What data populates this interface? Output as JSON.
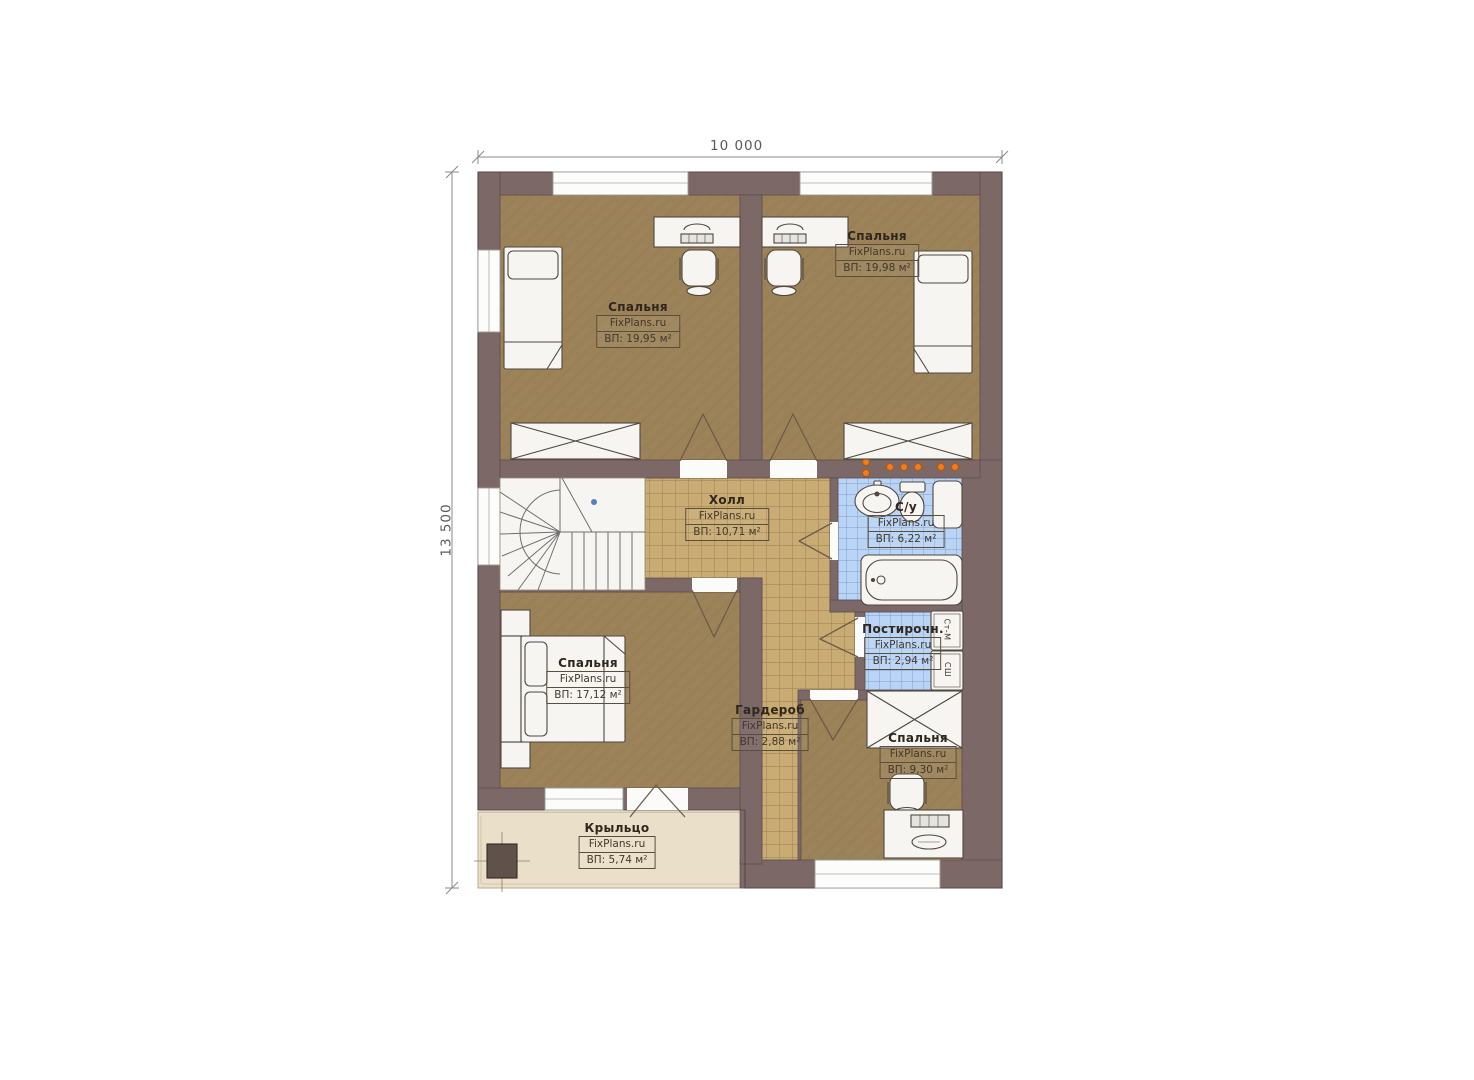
{
  "plan": {
    "type": "floor-plan",
    "watermark": "FixPlans.ru",
    "dimensions": {
      "width": "10 000",
      "height": "13 500"
    },
    "rooms": [
      {
        "id": "bedroom-top-left",
        "name": "Спальня",
        "watermark": "FixPlans.ru",
        "area": "ВП: 19,95 м²"
      },
      {
        "id": "bedroom-top-right",
        "name": "Спальня",
        "watermark": "FixPlans.ru",
        "area": "ВП: 19,98 м²"
      },
      {
        "id": "hall",
        "name": "Холл",
        "watermark": "FixPlans.ru",
        "area": "ВП: 10,71 м²"
      },
      {
        "id": "bathroom",
        "name": "С/у",
        "watermark": "FixPlans.ru",
        "area": "ВП: 6,22 м²"
      },
      {
        "id": "laundry",
        "name": "Постирочн.",
        "watermark": "FixPlans.ru",
        "area": "ВП: 2,94 м²"
      },
      {
        "id": "bedroom-bottom-left",
        "name": "Спальня",
        "watermark": "FixPlans.ru",
        "area": "ВП: 17,12 м²"
      },
      {
        "id": "wardrobe",
        "name": "Гардероб",
        "watermark": "FixPlans.ru",
        "area": "ВП: 2,88 м²"
      },
      {
        "id": "bedroom-bottom-right",
        "name": "Спальня",
        "watermark": "FixPlans.ru",
        "area": "ВП: 9,30 м²"
      },
      {
        "id": "porch",
        "name": "Крыльцо",
        "watermark": "FixPlans.ru",
        "area": "ВП: 5,74 м²"
      }
    ],
    "appliances": [
      {
        "label": "Ст-М"
      },
      {
        "label": "СШ"
      }
    ],
    "colors": {
      "wall": "#7d6868",
      "carpet": "#9b8259",
      "hall_tile": "#c9ac74",
      "bath_tile": "#b9d4f4",
      "porch": "#eadfc9",
      "radiator_accent": "#ef7d1f",
      "marker_blue": "#5580c0"
    }
  }
}
